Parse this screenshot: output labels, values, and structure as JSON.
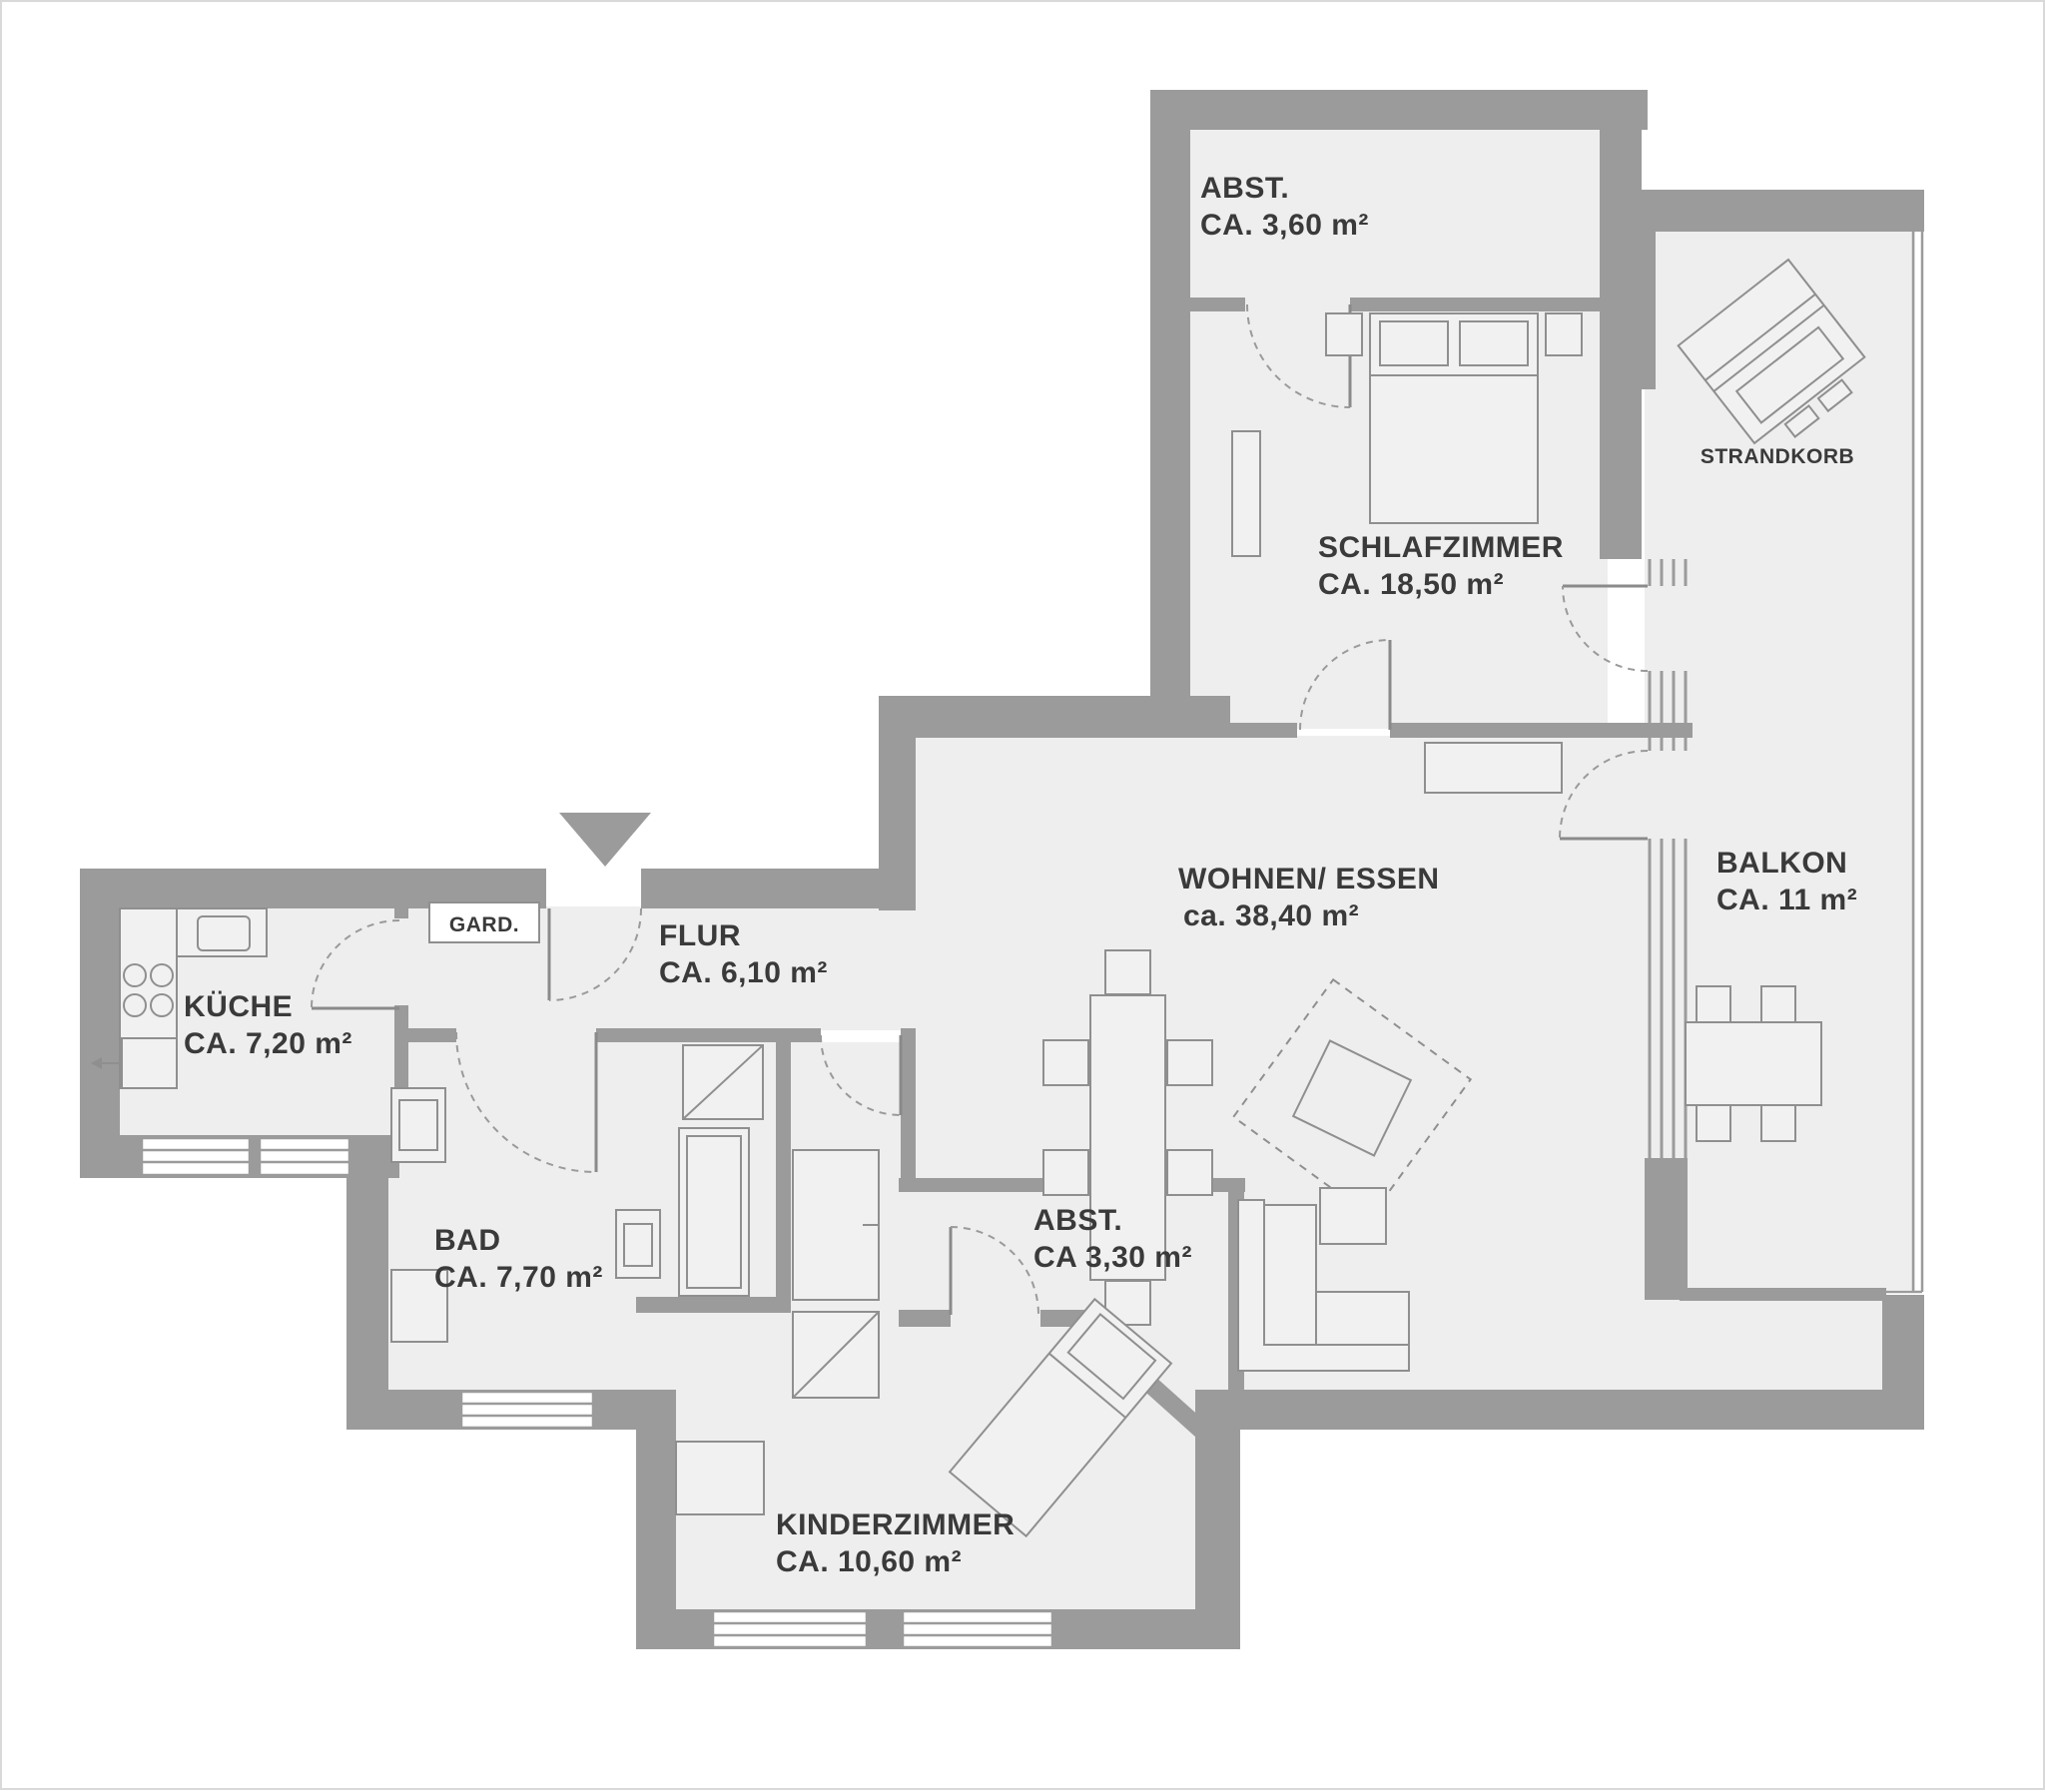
{
  "plan": {
    "rooms": {
      "abst_oben": {
        "name": "ABST.",
        "area": "CA. 3,60 m²"
      },
      "schlafzimmer": {
        "name": "SCHLAFZIMMER",
        "area": "CA. 18,50 m²"
      },
      "balkon": {
        "name": "BALKON",
        "area": "CA. 11 m²"
      },
      "wohnen_essen": {
        "name": "WOHNEN/ ESSEN",
        "area": "ca. 38,40 m²"
      },
      "flur": {
        "name": "FLUR",
        "area": "CA. 6,10 m²"
      },
      "kueche": {
        "name": "KÜCHE",
        "area": "CA. 7,20 m²"
      },
      "bad": {
        "name": "BAD",
        "area": "CA. 7,70 m²"
      },
      "abst_mitte": {
        "name": "ABST.",
        "area": "CA 3,30 m²"
      },
      "kinderzimmer": {
        "name": "KINDERZIMMER",
        "area": "CA. 10,60 m²"
      }
    },
    "annotations": {
      "strandkorb": "STRANDKORB",
      "garderobe": "GARD."
    },
    "colors": {
      "wall": "#9b9b9b",
      "room_fill": "#eeeeee",
      "furniture_outline": "#8f8f8f",
      "text": "#3a3a3a"
    }
  }
}
